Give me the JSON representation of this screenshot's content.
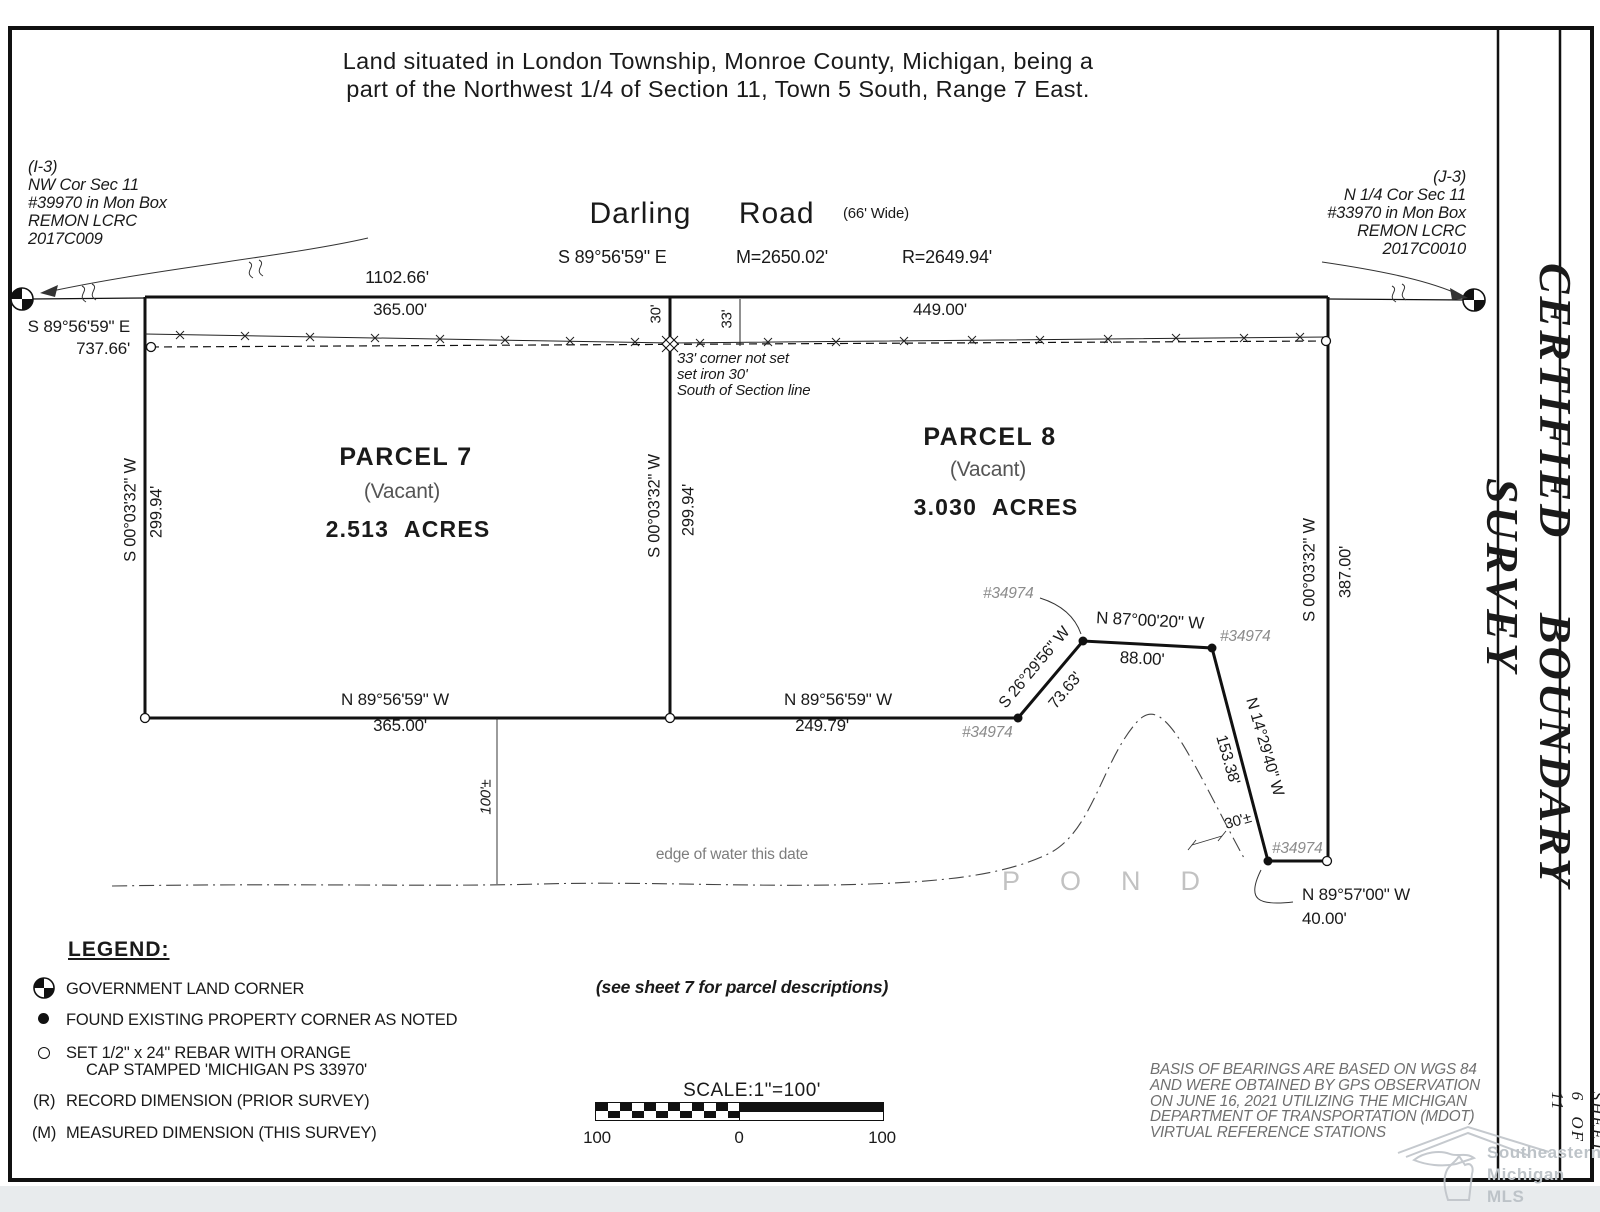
{
  "page": {
    "title_line1": "Land situated in London Township, Monroe County, Michigan, being a",
    "title_line2": "part of the Northwest 1/4 of Section 11, Town 5 South, Range 7 East."
  },
  "corner_left": {
    "lines": [
      "(I-3)",
      "NW Cor Sec 11",
      "#39970 in Mon Box",
      "REMON LCRC",
      "2017C009"
    ],
    "bearing": "S 89°56'59\" E",
    "distance": "737.66'"
  },
  "corner_right": {
    "lines": [
      "(J-3)",
      "N 1/4 Cor Sec 11",
      "#33970 in Mon Box",
      "REMON LCRC",
      "2017C0010"
    ]
  },
  "road": {
    "name": "Darling Road",
    "width_note": "(66' Wide)",
    "bearing": "S 89°56'59\" E",
    "measured": "M=2650.02'",
    "record": "R=2649.94'"
  },
  "north": {
    "overall": "1102.66'",
    "p7_frontage": "365.00'",
    "p8_frontage": "449.00'",
    "off30": "30'",
    "off33": "33'",
    "note": [
      "33' corner not set",
      "set iron 30'",
      "South of Section line"
    ]
  },
  "p7": {
    "name": "PARCEL 7",
    "vacant": "(Vacant)",
    "area": "2.513 ACRES",
    "west_bearing": "S 00°03'32\" W",
    "west_dist": "299.94'",
    "south_bearing": "N 89°56'59\" W",
    "south_dist": "365.00'"
  },
  "p8": {
    "name": "PARCEL 8",
    "vacant": "(Vacant)",
    "area": "3.030 ACRES",
    "west_bearing": "S 00°03'32\" W",
    "west_dist": "299.94'",
    "east_bearing": "S 00°03'32\" W",
    "east_dist": "387.00'",
    "south_bearing": "N 89°56'59\" W",
    "south_dist": "249.79'",
    "jog1_bearing": "S 26°29'56\" W",
    "jog1_dist": "73.63'",
    "jog2_bearing": "N 87°00'20\" W",
    "jog2_dist": "88.00'",
    "jog3_bearing": "N 14°29'40\" W",
    "jog3_dist": "153.38'",
    "jog4_bearing": "N 89°57'00\" W",
    "jog4_dist": "40.00'",
    "water_off": "30'±"
  },
  "marker_id": "#34974",
  "pond": {
    "offset": "100'±",
    "edge_label": "edge of water this date",
    "name": "POND"
  },
  "legend": {
    "title": "LEGEND:",
    "items": [
      {
        "text": "GOVERNMENT LAND CORNER"
      },
      {
        "text": "FOUND EXISTING PROPERTY CORNER AS NOTED"
      },
      {
        "text": "SET 1/2\" x 24\" REBAR WITH ORANGE",
        "text2": "CAP STAMPED 'MICHIGAN PS 33970'"
      },
      {
        "prefix": "(R)",
        "text": "RECORD DIMENSION (PRIOR SURVEY)"
      },
      {
        "prefix": "(M)",
        "text": "MEASURED DIMENSION (THIS SURVEY)"
      }
    ]
  },
  "notes": {
    "see_sheet": "(see sheet 7 for parcel descriptions)",
    "basis": [
      "BASIS OF BEARINGS ARE BASED ON WGS 84",
      "AND WERE OBTAINED BY GPS OBSERVATION",
      "ON JUNE 16, 2021 UTILIZING THE MICHIGAN",
      "DEPARTMENT OF TRANSPORTATION (MDOT)",
      "VIRTUAL REFERENCE STATIONS"
    ]
  },
  "scale": {
    "label": "SCALE:1\"=100'",
    "left": "100",
    "zero": "0",
    "right": "100"
  },
  "sidebar": {
    "title": "CERTIFIED BOUNDARY SURVEY",
    "sheet": "SHEET 6 OF 11"
  },
  "watermark": {
    "lines": [
      "Southeastern",
      "Michigan",
      "MLS"
    ]
  },
  "colors": {
    "ink": "#1a1a1a",
    "gray": "#8c8c8c",
    "light": "#bdc3c8"
  }
}
